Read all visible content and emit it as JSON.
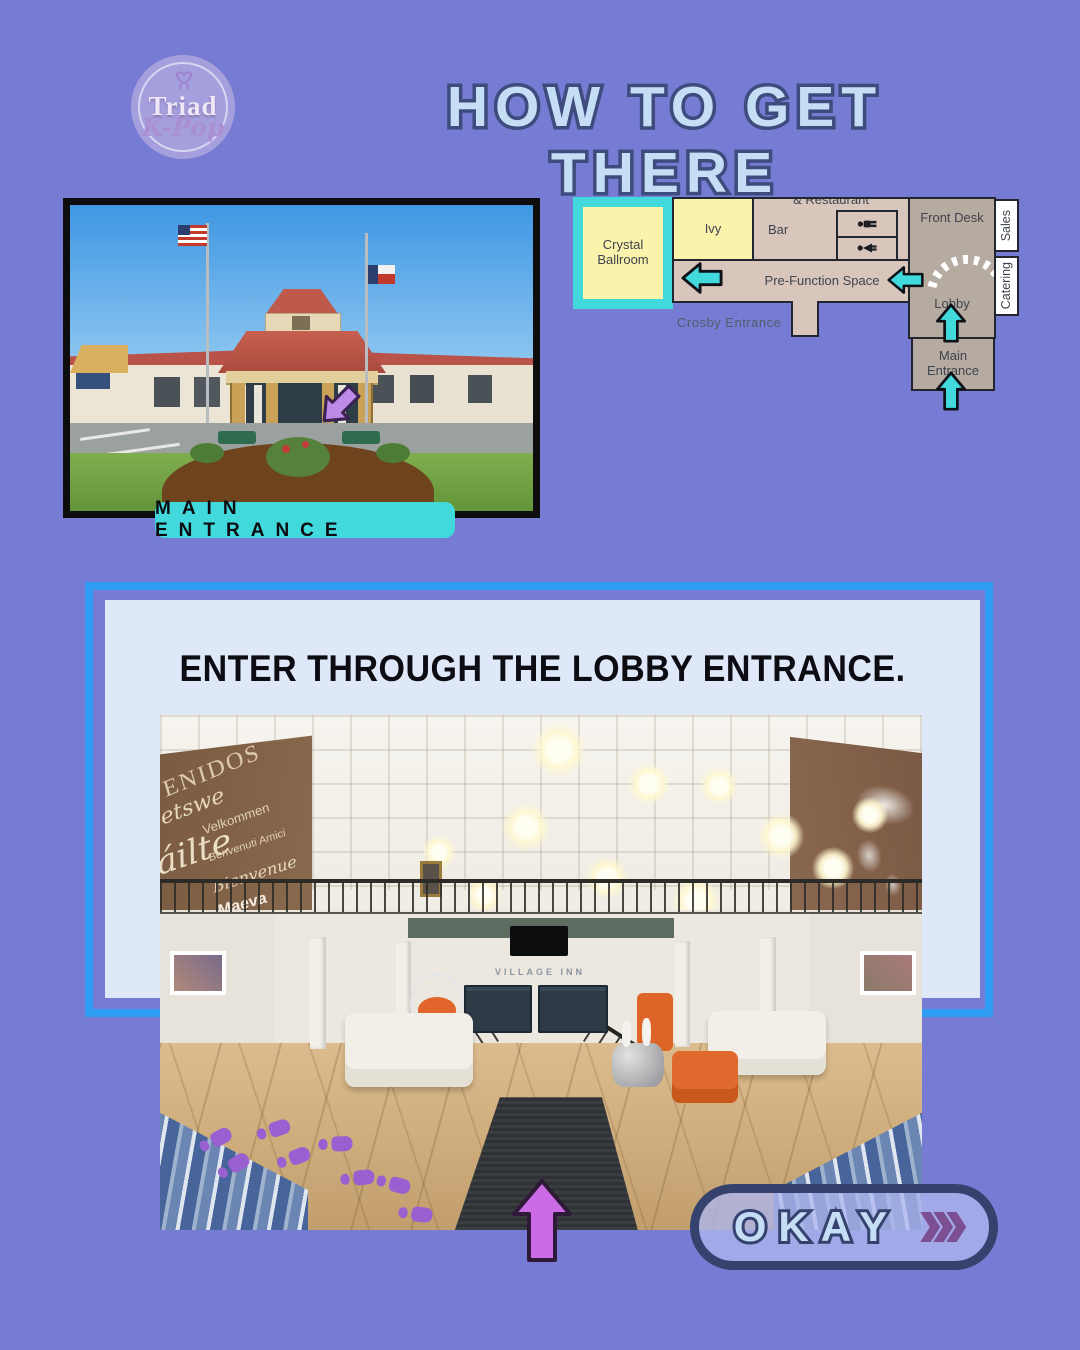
{
  "page": {
    "background_color": "#767CD4"
  },
  "logo": {
    "name": "Triad",
    "sub": "K-Pop"
  },
  "header": {
    "title": "HOW TO GET THERE",
    "text_color": "#C6DDF6",
    "outline_color": "#3D4B7D"
  },
  "entrance_section": {
    "label": "MAIN ENTRANCE",
    "label_color": "#41D9DC"
  },
  "floorplan": {
    "labels": {
      "restaurant": "& Restaurant",
      "ivy": "Ivy",
      "bar": "Bar",
      "front_desk": "Front Desk",
      "sales": "Sales",
      "catering": "Catering",
      "crystal_ballroom": "Crystal Ballroom",
      "pre_function": "Pre-Function Space",
      "lobby": "Lobby",
      "main_entrance": "Main Entrance",
      "crosby_entrance": "Crosby Entrance"
    },
    "colors": {
      "highlight_teal": "#41D9DC",
      "highlight_yellow": "#FAF3AC",
      "room_light": "#D8C5BC",
      "room_dark": "#B6ABA1",
      "outline": "#23262E"
    }
  },
  "instruction_card": {
    "text": "ENTER THROUGH THE LOBBY ENTRANCE.",
    "border_color": "#2F9DF4",
    "fill_color": "#DFE8F8"
  },
  "lobby_photo": {
    "desk_sign": "VILLAGE INN",
    "welcome_words": [
      "ENIDOS",
      "etswe",
      "Velkommen",
      "áilte",
      "Benvenuti Amici",
      "Bienvenue",
      "Maeva"
    ],
    "annotations": {
      "footprints_color": "#9A5FD0",
      "arrow_color": "#CB6CE6"
    }
  },
  "okay_button": {
    "label": "OKAY",
    "chevron_color": "#7C4F92",
    "border_color": "#35426E"
  }
}
